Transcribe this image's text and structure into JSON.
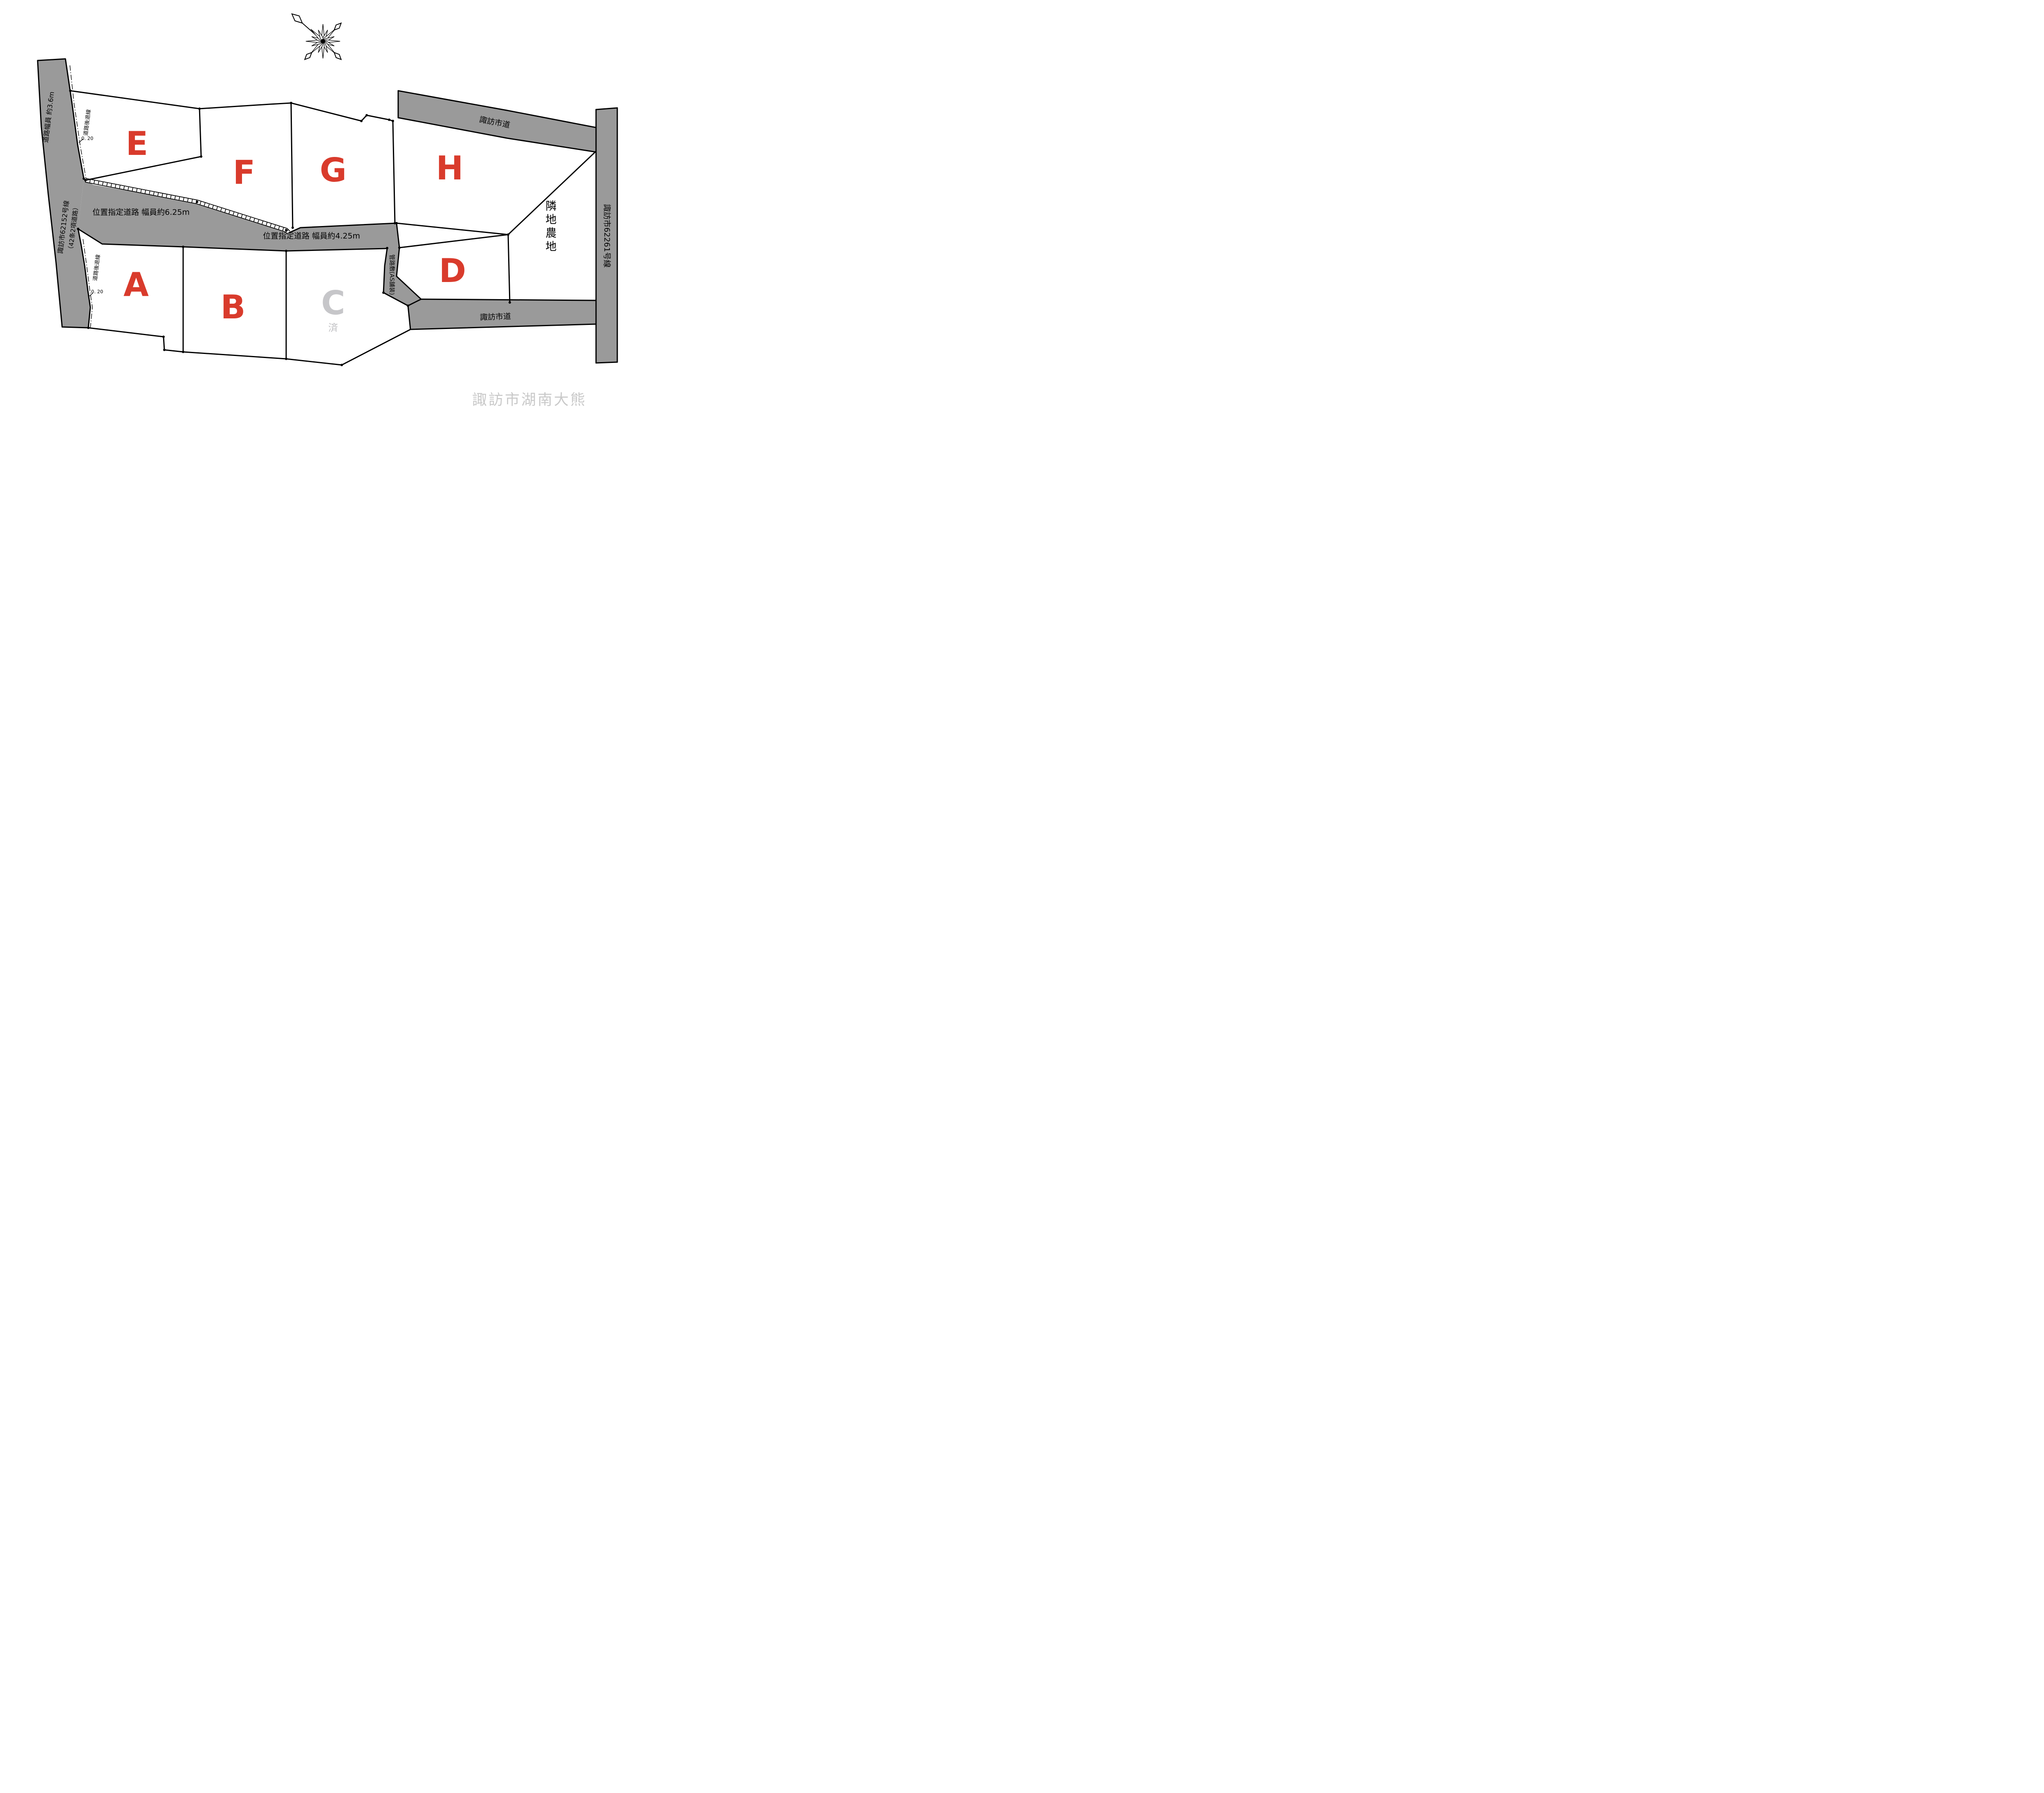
{
  "map": {
    "title": "区画図",
    "location_label": "諏訪市湖南大熊",
    "lots": [
      {
        "id": "A",
        "label": "A",
        "status": "available"
      },
      {
        "id": "B",
        "label": "B",
        "status": "available"
      },
      {
        "id": "C",
        "label": "C",
        "status": "sold",
        "sold_mark": "済"
      },
      {
        "id": "D",
        "label": "D",
        "status": "available"
      },
      {
        "id": "E",
        "label": "E",
        "status": "available"
      },
      {
        "id": "F",
        "label": "F",
        "status": "available"
      },
      {
        "id": "G",
        "label": "G",
        "status": "available"
      },
      {
        "id": "H",
        "label": "H",
        "status": "available"
      }
    ],
    "roads": {
      "left_name": "諏訪市62152号線",
      "left_name_sub": "（42条2項道路）",
      "left_width": "道路幅員 約3.6m",
      "right_name": "諏訪市62261号線",
      "top_name": "諏訪市道",
      "bottom_name": "諏訪市道",
      "middle_625": "位置指定道路 幅員約6.25m",
      "middle_425": "位置指定道路 幅員約4.25m",
      "duct": "管路敷(AS舗装)"
    },
    "setback": {
      "line": "道路後退線",
      "offset": "0. 20"
    },
    "farmland": {
      "label": "隣地農地",
      "chars": [
        "隣",
        "地",
        "農",
        "地"
      ]
    },
    "icons": {
      "compass": "compass-north-arrow"
    },
    "colors": {
      "road_gray": "#9a9a9a",
      "lot_label_red": "#d93b2c",
      "sold_lot_gray": "#c6c6c9",
      "location_gray": "#c9c9c9",
      "line_black": "#000000"
    }
  }
}
